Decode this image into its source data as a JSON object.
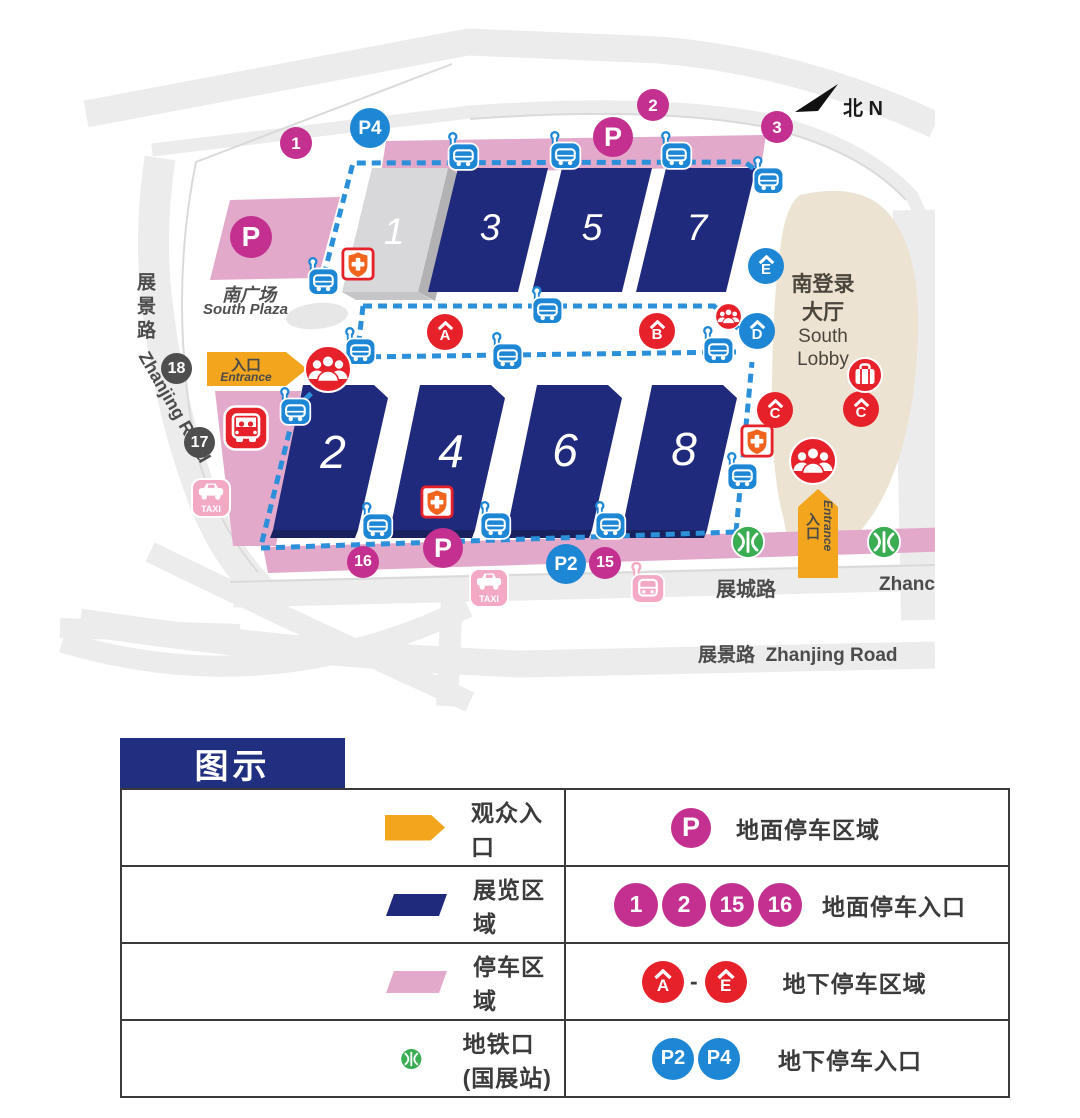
{
  "map": {
    "north_label": "北 N",
    "roads": {
      "left_cn": "展景路",
      "left_en": "Zhanjing Road",
      "mid_cn": "展城路",
      "mid_en_cut": "Zhanc",
      "bottom_cn": "展景路",
      "bottom_en": "Zhanjing Road"
    },
    "south_plaza": {
      "cn": "南广场",
      "en": "South Plaza"
    },
    "south_lobby": {
      "cn_line1": "南登录",
      "cn_line2": "大厅",
      "en_line1": "South",
      "en_line2": "Lobby"
    },
    "entrance_west": {
      "cn": "入口",
      "en": "Entrance"
    },
    "entrance_south": {
      "cn": "入口",
      "en": "Entrance"
    },
    "halls": [
      {
        "num": "1"
      },
      {
        "num": "3"
      },
      {
        "num": "5"
      },
      {
        "num": "7"
      },
      {
        "num": "2"
      },
      {
        "num": "4"
      },
      {
        "num": "6"
      },
      {
        "num": "8"
      }
    ],
    "badges": {
      "p_surface_north": "P",
      "p_surface_plaza": "P",
      "p_surface_south": "P",
      "p4": "P4",
      "p2": "P2",
      "gate1": "1",
      "gate2": "2",
      "gate3": "3",
      "gate15": "15",
      "gate16": "16",
      "road17": "17",
      "road18": "18",
      "areaA": "A",
      "areaB": "B",
      "areaC_west": "C",
      "areaC_east": "C",
      "areaD": "D",
      "areaE": "E"
    },
    "taxi_label": "TAXI"
  },
  "legend": {
    "header": "图示",
    "left_rows": [
      {
        "label": "观众入口"
      },
      {
        "label": "展览区域"
      },
      {
        "label": "停车区域"
      },
      {
        "label": "地铁口(国展站)"
      }
    ],
    "right_rows": [
      {
        "badge": "P",
        "label": "地面停车区域"
      },
      {
        "badges": [
          "1",
          "2",
          "15",
          "16"
        ],
        "label": "地面停车入口"
      },
      {
        "badge_from": "A",
        "separator": "-",
        "badge_to": "E",
        "label": "地下停车区域"
      },
      {
        "badges": [
          "P2",
          "P4"
        ],
        "label": "地下停车入口"
      }
    ]
  }
}
